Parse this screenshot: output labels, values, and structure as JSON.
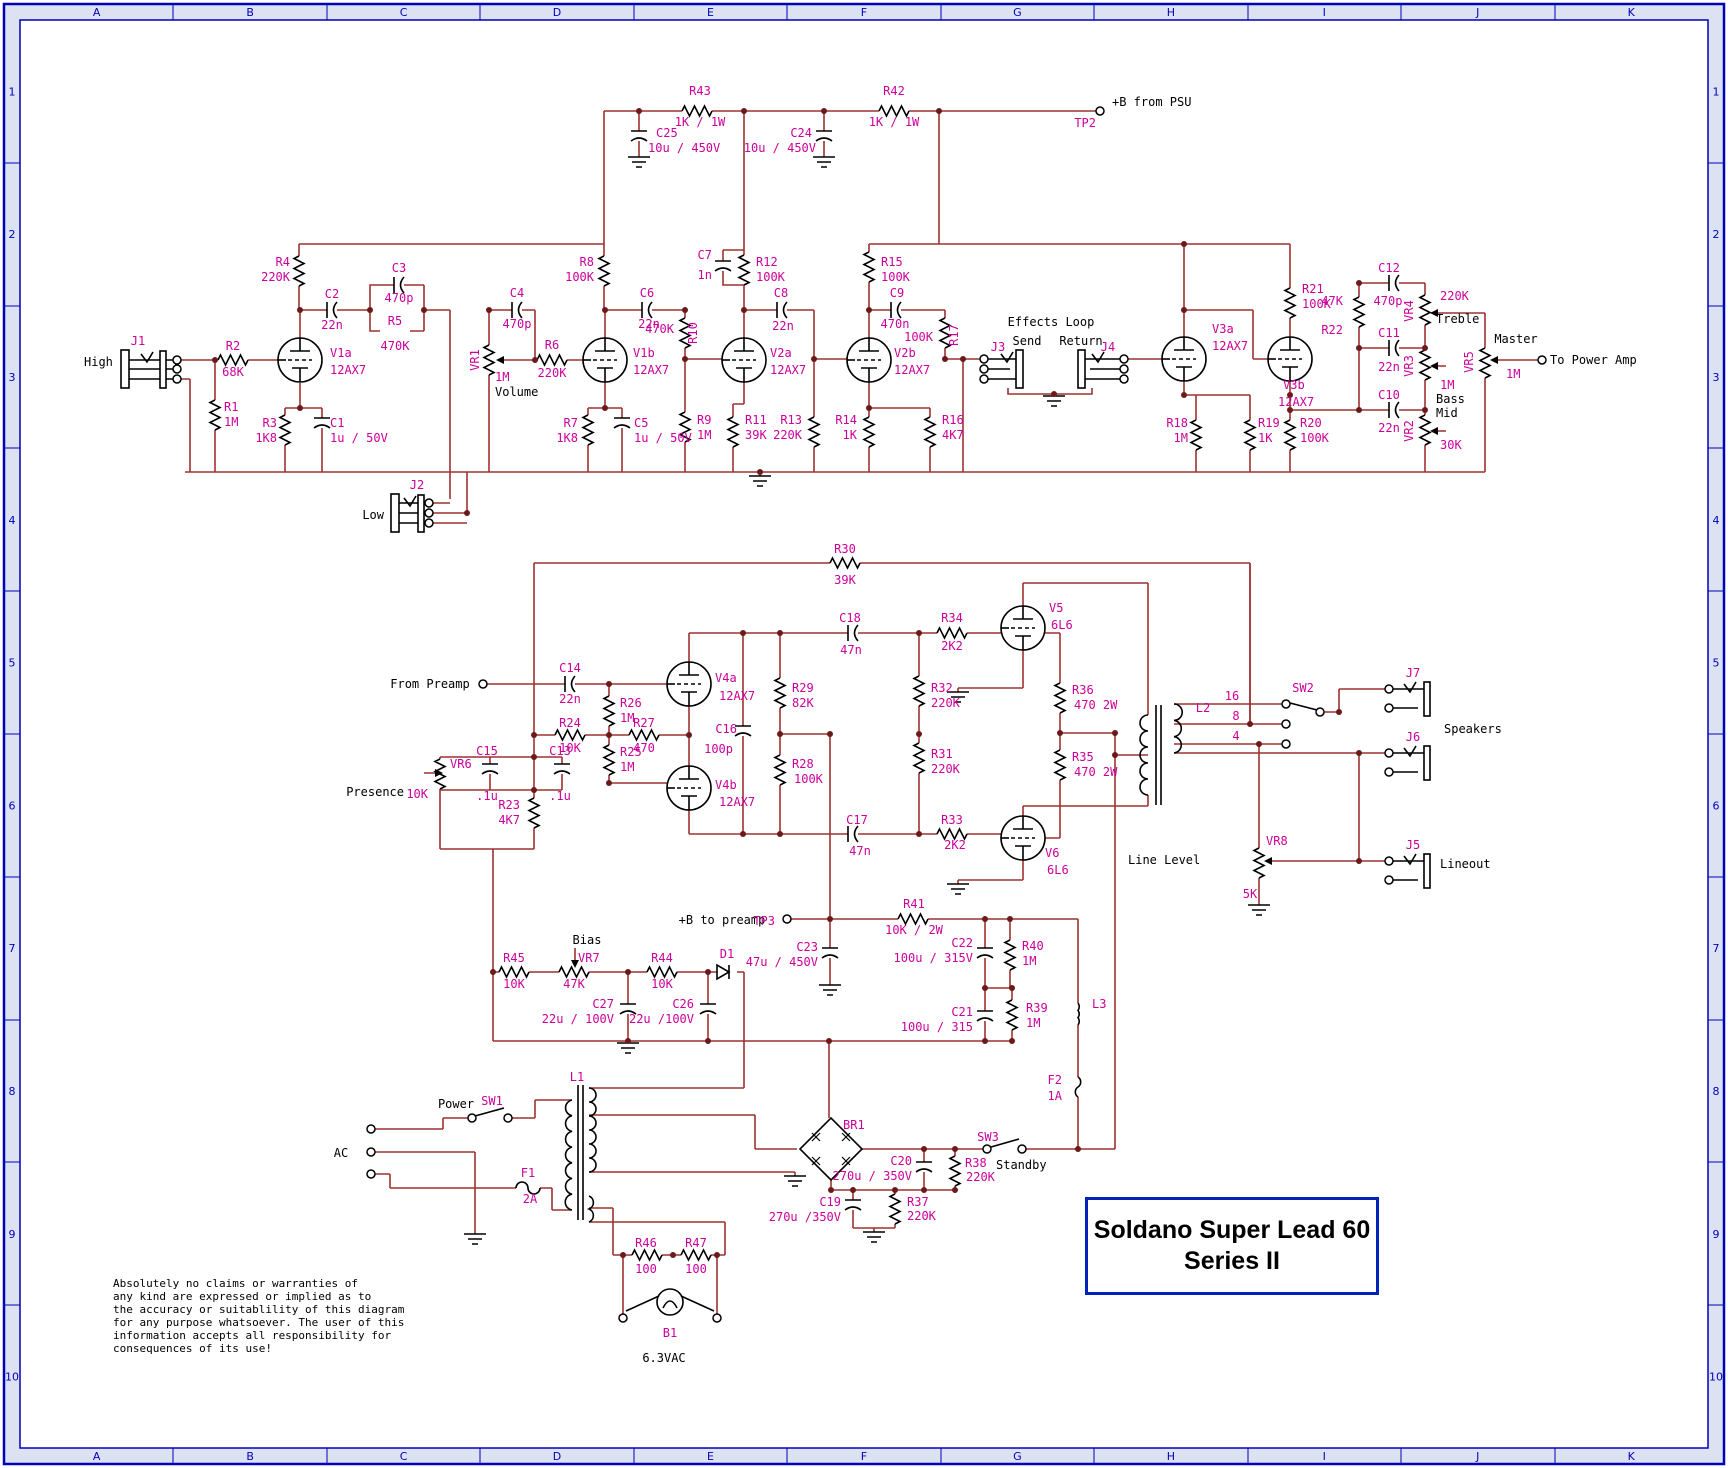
{
  "colors": {
    "wire": "#9e3232",
    "symbol": "#000000",
    "label_magenta": "#cc0099",
    "label_black": "#000000",
    "border_blue": "#0000bb",
    "border_strip": "#dde2f2",
    "junction_dot": "#6b1a1a"
  },
  "title_block": {
    "line1": "Soldano Super Lead 60",
    "line2": "Series II"
  },
  "disclaimer": [
    "Absolutely no claims or warranties of",
    "any kind are expressed or implied as to",
    "the accuracy or suitablility of this diagram",
    "for any purpose whatsoever.  The user of this",
    "information accepts all responsibility for",
    "consequences of its use!"
  ],
  "grid": {
    "columns": [
      "A",
      "B",
      "C",
      "D",
      "E",
      "F",
      "G",
      "H",
      "I",
      "J",
      "K"
    ],
    "rows": [
      "1",
      "2",
      "3",
      "4",
      "5",
      "6",
      "7",
      "8",
      "9",
      "10"
    ]
  },
  "labels": [
    {
      "t": "R43",
      "x": 700,
      "y": 95
    },
    {
      "t": "1K / 1W",
      "x": 700,
      "y": 126
    },
    {
      "t": "C25",
      "x": 656,
      "y": 137,
      "a": "s"
    },
    {
      "t": "10u / 450V",
      "x": 648,
      "y": 152,
      "a": "s"
    },
    {
      "t": "C24",
      "x": 812,
      "y": 137,
      "a": "e"
    },
    {
      "t": "10u / 450V",
      "x": 816,
      "y": 152,
      "a": "e"
    },
    {
      "t": "R42",
      "x": 894,
      "y": 95
    },
    {
      "t": "1K / 1W",
      "x": 894,
      "y": 126
    },
    {
      "t": "+B from PSU",
      "x": 1112,
      "y": 106,
      "c": "k",
      "a": "s"
    },
    {
      "t": "TP2",
      "x": 1096,
      "y": 127,
      "a": "e"
    },
    {
      "t": "J1",
      "x": 138,
      "y": 345
    },
    {
      "t": "High",
      "x": 84,
      "y": 366,
      "c": "k",
      "a": "s"
    },
    {
      "t": "R2",
      "x": 233,
      "y": 350
    },
    {
      "t": "68K",
      "x": 233,
      "y": 376
    },
    {
      "t": "R1",
      "x": 224,
      "y": 411,
      "a": "s"
    },
    {
      "t": "1M",
      "x": 224,
      "y": 426,
      "a": "s"
    },
    {
      "t": "R3",
      "x": 277,
      "y": 427,
      "a": "e"
    },
    {
      "t": "1K8",
      "x": 277,
      "y": 442,
      "a": "e"
    },
    {
      "t": "C1",
      "x": 330,
      "y": 427,
      "a": "s"
    },
    {
      "t": "1u / 50V",
      "x": 330,
      "y": 442,
      "a": "s"
    },
    {
      "t": "V1a",
      "x": 330,
      "y": 357,
      "a": "s"
    },
    {
      "t": "12AX7",
      "x": 330,
      "y": 374,
      "a": "s"
    },
    {
      "t": "R4",
      "x": 290,
      "y": 266,
      "a": "e"
    },
    {
      "t": "220K",
      "x": 290,
      "y": 281,
      "a": "e"
    },
    {
      "t": "C2",
      "x": 332,
      "y": 298
    },
    {
      "t": "22n",
      "x": 332,
      "y": 329
    },
    {
      "t": "C3",
      "x": 399,
      "y": 272
    },
    {
      "t": "470p",
      "x": 399,
      "y": 302
    },
    {
      "t": "R5",
      "x": 395,
      "y": 325
    },
    {
      "t": "470K",
      "x": 395,
      "y": 350
    },
    {
      "t": "C4",
      "x": 517,
      "y": 297
    },
    {
      "t": "470p",
      "x": 517,
      "y": 328
    },
    {
      "t": "VR1",
      "x": 479,
      "y": 360,
      "r": 1
    },
    {
      "t": "1M",
      "x": 495,
      "y": 381,
      "a": "s"
    },
    {
      "t": "Volume",
      "x": 495,
      "y": 396,
      "c": "k",
      "a": "s"
    },
    {
      "t": "R6",
      "x": 552,
      "y": 349
    },
    {
      "t": "220K",
      "x": 552,
      "y": 377
    },
    {
      "t": "V1b",
      "x": 633,
      "y": 357,
      "a": "s"
    },
    {
      "t": "12AX7",
      "x": 633,
      "y": 374,
      "a": "s"
    },
    {
      "t": "R8",
      "x": 594,
      "y": 266,
      "a": "e"
    },
    {
      "t": "100K",
      "x": 594,
      "y": 281,
      "a": "e"
    },
    {
      "t": "C6",
      "x": 647,
      "y": 297
    },
    {
      "t": "22n",
      "x": 649,
      "y": 328
    },
    {
      "t": "470K",
      "x": 674,
      "y": 333,
      "a": "e"
    },
    {
      "t": "R10",
      "x": 697,
      "y": 333,
      "r": 1
    },
    {
      "t": "R7",
      "x": 578,
      "y": 427,
      "a": "e"
    },
    {
      "t": "1K8",
      "x": 578,
      "y": 442,
      "a": "e"
    },
    {
      "t": "C5",
      "x": 634,
      "y": 427,
      "a": "s"
    },
    {
      "t": "1u / 50V",
      "x": 634,
      "y": 442,
      "a": "s"
    },
    {
      "t": "R9",
      "x": 697,
      "y": 424,
      "a": "s"
    },
    {
      "t": "1M",
      "x": 697,
      "y": 439,
      "a": "s"
    },
    {
      "t": "J2",
      "x": 417,
      "y": 489
    },
    {
      "t": "Low",
      "x": 384,
      "y": 519,
      "c": "k",
      "a": "e"
    },
    {
      "t": "C7",
      "x": 712,
      "y": 259,
      "a": "e"
    },
    {
      "t": "1n",
      "x": 712,
      "y": 279,
      "a": "e"
    },
    {
      "t": "R12",
      "x": 756,
      "y": 266,
      "a": "s"
    },
    {
      "t": "100K",
      "x": 756,
      "y": 281,
      "a": "s"
    },
    {
      "t": "C8",
      "x": 781,
      "y": 297
    },
    {
      "t": "22n",
      "x": 783,
      "y": 330
    },
    {
      "t": "V2a",
      "x": 770,
      "y": 357,
      "a": "s"
    },
    {
      "t": "12AX7",
      "x": 770,
      "y": 374,
      "a": "s"
    },
    {
      "t": "R11",
      "x": 745,
      "y": 424,
      "a": "s"
    },
    {
      "t": "39K",
      "x": 745,
      "y": 439,
      "a": "s"
    },
    {
      "t": "R13",
      "x": 802,
      "y": 424,
      "a": "e"
    },
    {
      "t": "220K",
      "x": 802,
      "y": 439,
      "a": "e"
    },
    {
      "t": "R15",
      "x": 881,
      "y": 266,
      "a": "s"
    },
    {
      "t": "100K",
      "x": 881,
      "y": 281,
      "a": "s"
    },
    {
      "t": "C9",
      "x": 897,
      "y": 297
    },
    {
      "t": "470n",
      "x": 895,
      "y": 328
    },
    {
      "t": "100K",
      "x": 933,
      "y": 341,
      "a": "e"
    },
    {
      "t": "R17",
      "x": 958,
      "y": 335,
      "r": 1
    },
    {
      "t": "V2b",
      "x": 894,
      "y": 357,
      "a": "s"
    },
    {
      "t": "12AX7",
      "x": 894,
      "y": 374,
      "a": "s"
    },
    {
      "t": "R14",
      "x": 857,
      "y": 424,
      "a": "e"
    },
    {
      "t": "1K",
      "x": 857,
      "y": 439,
      "a": "e"
    },
    {
      "t": "R16",
      "x": 942,
      "y": 424,
      "a": "s"
    },
    {
      "t": "4K7",
      "x": 942,
      "y": 439,
      "a": "s"
    },
    {
      "t": "Effects Loop",
      "x": 1051,
      "y": 326,
      "c": "k"
    },
    {
      "t": "Send",
      "x": 1027,
      "y": 345,
      "c": "k"
    },
    {
      "t": "Return",
      "x": 1081,
      "y": 345,
      "c": "k"
    },
    {
      "t": "J3",
      "x": 998,
      "y": 351
    },
    {
      "t": "J4",
      "x": 1108,
      "y": 351
    },
    {
      "t": "V3a",
      "x": 1212,
      "y": 333,
      "a": "s"
    },
    {
      "t": "12AX7",
      "x": 1212,
      "y": 350,
      "a": "s"
    },
    {
      "t": "V3b",
      "x": 1283,
      "y": 389,
      "a": "s"
    },
    {
      "t": "12AX7",
      "x": 1278,
      "y": 406,
      "a": "s"
    },
    {
      "t": "R18",
      "x": 1188,
      "y": 427,
      "a": "e"
    },
    {
      "t": "1M",
      "x": 1188,
      "y": 442,
      "a": "e"
    },
    {
      "t": "R19",
      "x": 1258,
      "y": 427,
      "a": "s"
    },
    {
      "t": "1K",
      "x": 1258,
      "y": 442,
      "a": "s"
    },
    {
      "t": "R20",
      "x": 1300,
      "y": 427,
      "a": "s"
    },
    {
      "t": "100K",
      "x": 1300,
      "y": 442,
      "a": "s"
    },
    {
      "t": "R21",
      "x": 1302,
      "y": 293,
      "a": "s"
    },
    {
      "t": "100K",
      "x": 1302,
      "y": 308,
      "a": "s"
    },
    {
      "t": "C12",
      "x": 1389,
      "y": 272
    },
    {
      "t": "470p",
      "x": 1388,
      "y": 305
    },
    {
      "t": "47K",
      "x": 1343,
      "y": 305,
      "a": "e"
    },
    {
      "t": "R22",
      "x": 1343,
      "y": 334,
      "a": "e"
    },
    {
      "t": "C11",
      "x": 1389,
      "y": 337
    },
    {
      "t": "22n",
      "x": 1389,
      "y": 371
    },
    {
      "t": "C10",
      "x": 1389,
      "y": 399
    },
    {
      "t": "22n",
      "x": 1389,
      "y": 432
    },
    {
      "t": "VR4",
      "x": 1413,
      "y": 311,
      "r": 1
    },
    {
      "t": "220K",
      "x": 1440,
      "y": 300,
      "a": "s"
    },
    {
      "t": "Treble",
      "x": 1436,
      "y": 323,
      "c": "k",
      "a": "s"
    },
    {
      "t": "VR3",
      "x": 1413,
      "y": 366,
      "r": 1
    },
    {
      "t": "1M",
      "x": 1440,
      "y": 389,
      "a": "s"
    },
    {
      "t": "Bass",
      "x": 1436,
      "y": 403,
      "c": "k",
      "a": "s"
    },
    {
      "t": "Mid",
      "x": 1436,
      "y": 417,
      "c": "k",
      "a": "s"
    },
    {
      "t": "VR2",
      "x": 1413,
      "y": 431,
      "r": 1
    },
    {
      "t": "30K",
      "x": 1440,
      "y": 449,
      "a": "s"
    },
    {
      "t": "Master",
      "x": 1516,
      "y": 343,
      "c": "k"
    },
    {
      "t": "VR5",
      "x": 1473,
      "y": 362,
      "r": 1
    },
    {
      "t": "1M",
      "x": 1506,
      "y": 378,
      "a": "s"
    },
    {
      "t": "To Power Amp",
      "x": 1550,
      "y": 364,
      "c": "k",
      "a": "s"
    },
    {
      "t": "R30",
      "x": 845,
      "y": 553
    },
    {
      "t": "39K",
      "x": 845,
      "y": 584
    },
    {
      "t": "From Preamp",
      "x": 430,
      "y": 688,
      "c": "k"
    },
    {
      "t": "C14",
      "x": 570,
      "y": 672
    },
    {
      "t": "22n",
      "x": 570,
      "y": 703
    },
    {
      "t": "V4a",
      "x": 715,
      "y": 682,
      "a": "s"
    },
    {
      "t": "12AX7",
      "x": 719,
      "y": 700,
      "a": "s"
    },
    {
      "t": "R26",
      "x": 620,
      "y": 707,
      "a": "s"
    },
    {
      "t": "1M",
      "x": 620,
      "y": 722,
      "a": "s"
    },
    {
      "t": "R24",
      "x": 570,
      "y": 727
    },
    {
      "t": "10K",
      "x": 570,
      "y": 752
    },
    {
      "t": "R27",
      "x": 644,
      "y": 727
    },
    {
      "t": "470",
      "x": 644,
      "y": 752
    },
    {
      "t": "R25",
      "x": 620,
      "y": 756,
      "a": "s"
    },
    {
      "t": "1M",
      "x": 620,
      "y": 771,
      "a": "s"
    },
    {
      "t": "C16",
      "x": 737,
      "y": 733,
      "a": "e"
    },
    {
      "t": "100p",
      "x": 733,
      "y": 753,
      "a": "e"
    },
    {
      "t": "V4b",
      "x": 715,
      "y": 789,
      "a": "s"
    },
    {
      "t": "12AX7",
      "x": 719,
      "y": 806,
      "a": "s"
    },
    {
      "t": "VR6",
      "x": 450,
      "y": 768,
      "a": "s"
    },
    {
      "t": "10K",
      "x": 428,
      "y": 798,
      "a": "e"
    },
    {
      "t": "Presence",
      "x": 404,
      "y": 796,
      "c": "k",
      "a": "e"
    },
    {
      "t": "C15",
      "x": 487,
      "y": 755
    },
    {
      "t": ".1u",
      "x": 487,
      "y": 800
    },
    {
      "t": "C13",
      "x": 560,
      "y": 755
    },
    {
      "t": ".1u",
      "x": 560,
      "y": 800
    },
    {
      "t": "R23",
      "x": 520,
      "y": 809,
      "a": "e"
    },
    {
      "t": "4K7",
      "x": 520,
      "y": 824,
      "a": "e"
    },
    {
      "t": "C18",
      "x": 850,
      "y": 622
    },
    {
      "t": "47n",
      "x": 851,
      "y": 654
    },
    {
      "t": "R34",
      "x": 952,
      "y": 622
    },
    {
      "t": "2K2",
      "x": 952,
      "y": 650
    },
    {
      "t": "V5",
      "x": 1049,
      "y": 612,
      "a": "s"
    },
    {
      "t": "6L6",
      "x": 1051,
      "y": 629,
      "a": "s"
    },
    {
      "t": "R29",
      "x": 792,
      "y": 692,
      "a": "s"
    },
    {
      "t": "82K",
      "x": 792,
      "y": 707,
      "a": "s"
    },
    {
      "t": "R32",
      "x": 931,
      "y": 692,
      "a": "s"
    },
    {
      "t": "220K",
      "x": 931,
      "y": 707,
      "a": "s"
    },
    {
      "t": "R28",
      "x": 792,
      "y": 768,
      "a": "s"
    },
    {
      "t": "100K",
      "x": 794,
      "y": 783,
      "a": "s"
    },
    {
      "t": "R31",
      "x": 931,
      "y": 758,
      "a": "s"
    },
    {
      "t": "220K",
      "x": 931,
      "y": 773,
      "a": "s"
    },
    {
      "t": "C17",
      "x": 857,
      "y": 824
    },
    {
      "t": "47n",
      "x": 860,
      "y": 855
    },
    {
      "t": "R33",
      "x": 952,
      "y": 824
    },
    {
      "t": "2K2",
      "x": 955,
      "y": 849
    },
    {
      "t": "V6",
      "x": 1045,
      "y": 857,
      "a": "s"
    },
    {
      "t": "6L6",
      "x": 1047,
      "y": 874,
      "a": "s"
    },
    {
      "t": "R36",
      "x": 1072,
      "y": 694,
      "a": "s"
    },
    {
      "t": "470 2W",
      "x": 1074,
      "y": 709,
      "a": "s"
    },
    {
      "t": "R35",
      "x": 1072,
      "y": 761,
      "a": "s"
    },
    {
      "t": "470 2W",
      "x": 1074,
      "y": 776,
      "a": "s"
    },
    {
      "t": "L2",
      "x": 1203,
      "y": 712
    },
    {
      "t": "16",
      "x": 1232,
      "y": 700
    },
    {
      "t": "8",
      "x": 1236,
      "y": 720
    },
    {
      "t": "4",
      "x": 1236,
      "y": 740
    },
    {
      "t": "SW2",
      "x": 1303,
      "y": 692
    },
    {
      "t": "J7",
      "x": 1413,
      "y": 677
    },
    {
      "t": "J6",
      "x": 1413,
      "y": 741
    },
    {
      "t": "Speakers",
      "x": 1444,
      "y": 733,
      "c": "k",
      "a": "s"
    },
    {
      "t": "Line Level",
      "x": 1128,
      "y": 864,
      "c": "k",
      "a": "s"
    },
    {
      "t": "VR8",
      "x": 1266,
      "y": 845,
      "a": "s"
    },
    {
      "t": "5K",
      "x": 1250,
      "y": 898
    },
    {
      "t": "J5",
      "x": 1413,
      "y": 849
    },
    {
      "t": "Lineout",
      "x": 1440,
      "y": 868,
      "c": "k",
      "a": "s"
    },
    {
      "t": "+B to preamp",
      "x": 722,
      "y": 924,
      "c": "k"
    },
    {
      "t": "TP3",
      "x": 775,
      "y": 925,
      "a": "e"
    },
    {
      "t": "R41",
      "x": 914,
      "y": 908
    },
    {
      "t": "10K / 2W",
      "x": 914,
      "y": 934
    },
    {
      "t": "C23",
      "x": 818,
      "y": 951,
      "a": "e"
    },
    {
      "t": "47u / 450V",
      "x": 818,
      "y": 966,
      "a": "e"
    },
    {
      "t": "C22",
      "x": 973,
      "y": 947,
      "a": "e"
    },
    {
      "t": "100u / 315V",
      "x": 973,
      "y": 962,
      "a": "e"
    },
    {
      "t": "R40",
      "x": 1022,
      "y": 950,
      "a": "s"
    },
    {
      "t": "1M",
      "x": 1022,
      "y": 965,
      "a": "s"
    },
    {
      "t": "C21",
      "x": 973,
      "y": 1016,
      "a": "e"
    },
    {
      "t": "100u / 315",
      "x": 973,
      "y": 1031,
      "a": "e"
    },
    {
      "t": "R39",
      "x": 1026,
      "y": 1012,
      "a": "s"
    },
    {
      "t": "1M",
      "x": 1026,
      "y": 1027,
      "a": "s"
    },
    {
      "t": "L3",
      "x": 1092,
      "y": 1008,
      "a": "s"
    },
    {
      "t": "F2",
      "x": 1062,
      "y": 1084,
      "a": "e"
    },
    {
      "t": "1A",
      "x": 1062,
      "y": 1100,
      "a": "e"
    },
    {
      "t": "R45",
      "x": 514,
      "y": 962
    },
    {
      "t": "10K",
      "x": 514,
      "y": 988
    },
    {
      "t": "Bias",
      "x": 587,
      "y": 944,
      "c": "k"
    },
    {
      "t": "VR7",
      "x": 578,
      "y": 962,
      "a": "s"
    },
    {
      "t": "47K",
      "x": 574,
      "y": 988
    },
    {
      "t": "R44",
      "x": 662,
      "y": 962
    },
    {
      "t": "10K",
      "x": 662,
      "y": 988
    },
    {
      "t": "D1",
      "x": 727,
      "y": 958
    },
    {
      "t": "C27",
      "x": 614,
      "y": 1008,
      "a": "e"
    },
    {
      "t": "22u / 100V",
      "x": 614,
      "y": 1023,
      "a": "e"
    },
    {
      "t": "C26",
      "x": 694,
      "y": 1008,
      "a": "e"
    },
    {
      "t": "22u /100V",
      "x": 694,
      "y": 1023,
      "a": "e"
    },
    {
      "t": "L1",
      "x": 577,
      "y": 1081
    },
    {
      "t": "Power",
      "x": 456,
      "y": 1108,
      "c": "k"
    },
    {
      "t": "SW1",
      "x": 492,
      "y": 1105
    },
    {
      "t": "AC",
      "x": 341,
      "y": 1157,
      "c": "k"
    },
    {
      "t": "F1",
      "x": 528,
      "y": 1177
    },
    {
      "t": "2A",
      "x": 530,
      "y": 1203
    },
    {
      "t": "BR1",
      "x": 843,
      "y": 1129,
      "a": "s"
    },
    {
      "t": "C20",
      "x": 912,
      "y": 1165,
      "a": "e"
    },
    {
      "t": "270u / 350V",
      "x": 912,
      "y": 1180,
      "a": "e"
    },
    {
      "t": "R38",
      "x": 965,
      "y": 1167,
      "a": "s"
    },
    {
      "t": "220K",
      "x": 966,
      "y": 1181,
      "a": "s"
    },
    {
      "t": "SW3",
      "x": 988,
      "y": 1141
    },
    {
      "t": "Standby",
      "x": 996,
      "y": 1169,
      "c": "k",
      "a": "s"
    },
    {
      "t": "C19",
      "x": 841,
      "y": 1206,
      "a": "e"
    },
    {
      "t": "270u /350V",
      "x": 841,
      "y": 1221,
      "a": "e"
    },
    {
      "t": "R37",
      "x": 907,
      "y": 1206,
      "a": "s"
    },
    {
      "t": "220K",
      "x": 907,
      "y": 1220,
      "a": "s"
    },
    {
      "t": "R46",
      "x": 646,
      "y": 1247
    },
    {
      "t": "100",
      "x": 646,
      "y": 1273
    },
    {
      "t": "R47",
      "x": 696,
      "y": 1247
    },
    {
      "t": "100",
      "x": 696,
      "y": 1273
    },
    {
      "t": "B1",
      "x": 670,
      "y": 1337
    },
    {
      "t": "6.3VAC",
      "x": 664,
      "y": 1362,
      "c": "k"
    }
  ]
}
